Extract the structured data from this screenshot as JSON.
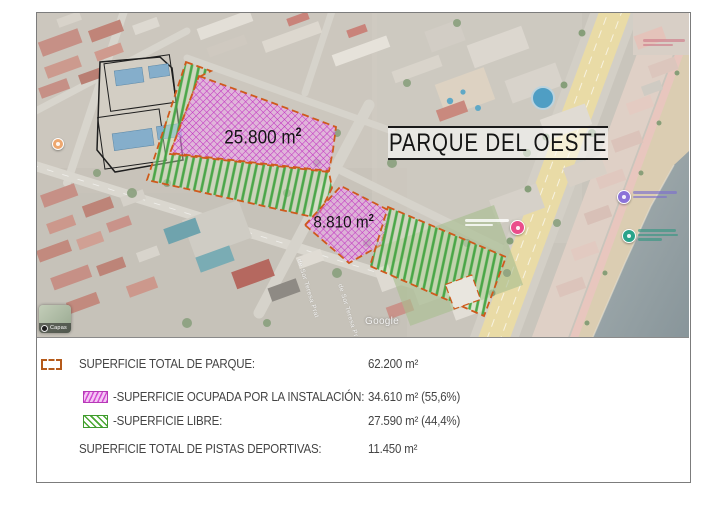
{
  "figure": {
    "title": "PARQUE DEL OESTE",
    "map": {
      "area_label_1": {
        "value": "25.800 m",
        "sup": "2"
      },
      "area_label_2": {
        "value": "8.810 m",
        "sup": "2"
      },
      "street_label": "de Sor Teresa Prat",
      "watermark": "Google",
      "layers_control_label": "Capas"
    },
    "legend": {
      "rows": [
        {
          "icon": "park-boundary-dashed",
          "label": "SUPERFICIE TOTAL DE PARQUE:",
          "value": "62.200 m²"
        },
        {
          "icon": "magenta-hatch",
          "label": "-SUPERFICIE OCUPADA POR LA INSTALACIÓN:",
          "value": "34.610 m² (55,6%)"
        },
        {
          "icon": "green-hatch",
          "label": "-SUPERFICIE LIBRE:",
          "value": "27.590 m² (44,4%)"
        },
        {
          "icon": "none",
          "label": "SUPERFICIE TOTAL DE PISTAS DEPORTIVAS:",
          "value": "11.450 m²"
        }
      ]
    },
    "colors": {
      "occupied_hatch": "#cc3fcc",
      "free_hatch": "#3fa33f",
      "boundary_dash": "#cf5a1c"
    }
  }
}
